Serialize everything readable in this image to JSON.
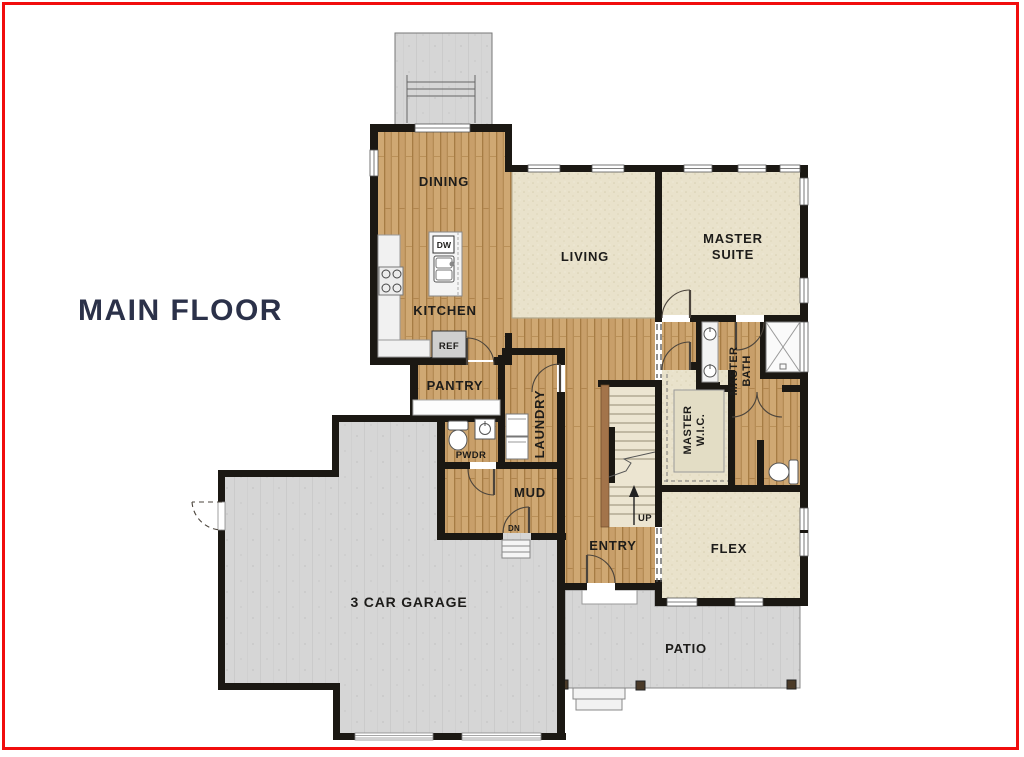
{
  "title": "MAIN FLOOR",
  "colors": {
    "border_red": "#f10d0d",
    "title_navy": "#2b3149",
    "wall_black": "#1b1813",
    "wood_floor": "#c89f6a",
    "carpet": "#e9e2cb",
    "concrete": "#d6d6d6"
  },
  "rooms": {
    "dining": {
      "label": "DINING"
    },
    "living": {
      "label": "LIVING"
    },
    "master_suite": {
      "line1": "MASTER",
      "line2": "SUITE"
    },
    "kitchen": {
      "label": "KITCHEN"
    },
    "pantry": {
      "label": "PANTRY"
    },
    "laundry": {
      "label": "LAUNDRY"
    },
    "pwdr": {
      "label": "PWDR"
    },
    "mud": {
      "label": "MUD"
    },
    "entry": {
      "label": "ENTRY"
    },
    "master_bath": {
      "line1": "MASTER",
      "line2": "BATH"
    },
    "master_wic": {
      "line1": "MASTER",
      "line2": "W.I.C."
    },
    "flex": {
      "label": "FLEX"
    },
    "garage": {
      "label": "3 CAR GARAGE"
    },
    "patio": {
      "label": "PATIO"
    }
  },
  "fixtures": {
    "dishwasher": "DW",
    "refrigerator": "REF"
  },
  "stairs": {
    "up": "UP",
    "down": "DN"
  }
}
